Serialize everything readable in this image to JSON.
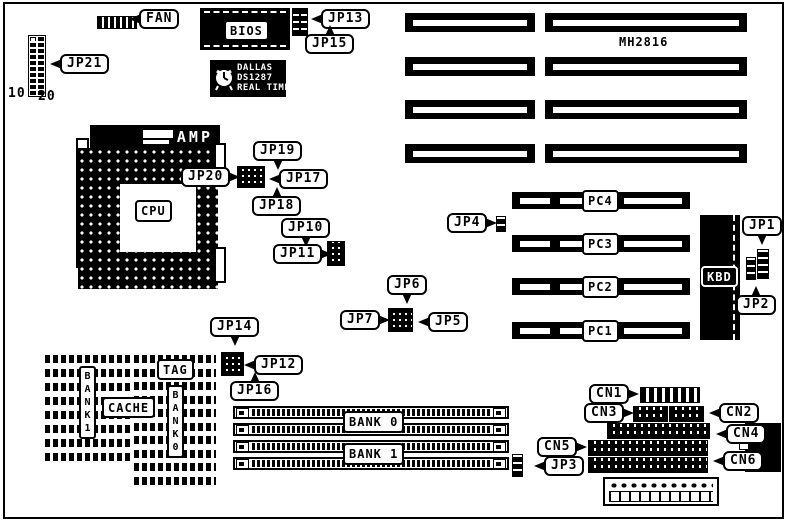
{
  "colors": {
    "foreground": "#000000",
    "background": "#ffffff"
  },
  "diagram": {
    "callouts": {
      "fan": "FAN",
      "jp21": "JP21",
      "jp13": "JP13",
      "jp15": "JP15",
      "jp19": "JP19",
      "jp20": "JP20",
      "jp17": "JP17",
      "jp18": "JP18",
      "jp10": "JP10",
      "jp11": "JP11",
      "jp6": "JP6",
      "jp7": "JP7",
      "jp5": "JP5",
      "jp4": "JP4",
      "jp1": "JP1",
      "jp2": "JP2",
      "jp14": "JP14",
      "jp12": "JP12",
      "jp16": "JP16",
      "jp3": "JP3",
      "cn1": "CN1",
      "cn2": "CN2",
      "cn3": "CN3",
      "cn4": "CN4",
      "cn5": "CN5",
      "cn6": "CN6"
    },
    "chips": {
      "bios": "BIOS",
      "amp": "AMP",
      "cpu": "CPU",
      "kbd": "KBD",
      "board": "MH2816"
    },
    "dallas": {
      "brand": "DALLAS",
      "model": "DS1287",
      "type": "REAL TIME"
    },
    "pci_slots": [
      "PC4",
      "PC3",
      "PC2",
      "PC1"
    ],
    "memory": {
      "bank0_label": "BANK 0",
      "bank1_label": "BANK 1"
    },
    "cache": {
      "tag": "TAG",
      "cache": "CACHE",
      "bank1_vertical": "BANK1",
      "bank0_vertical": "BANK0"
    },
    "jp21_pins": {
      "first": "10",
      "last": "20"
    }
  }
}
